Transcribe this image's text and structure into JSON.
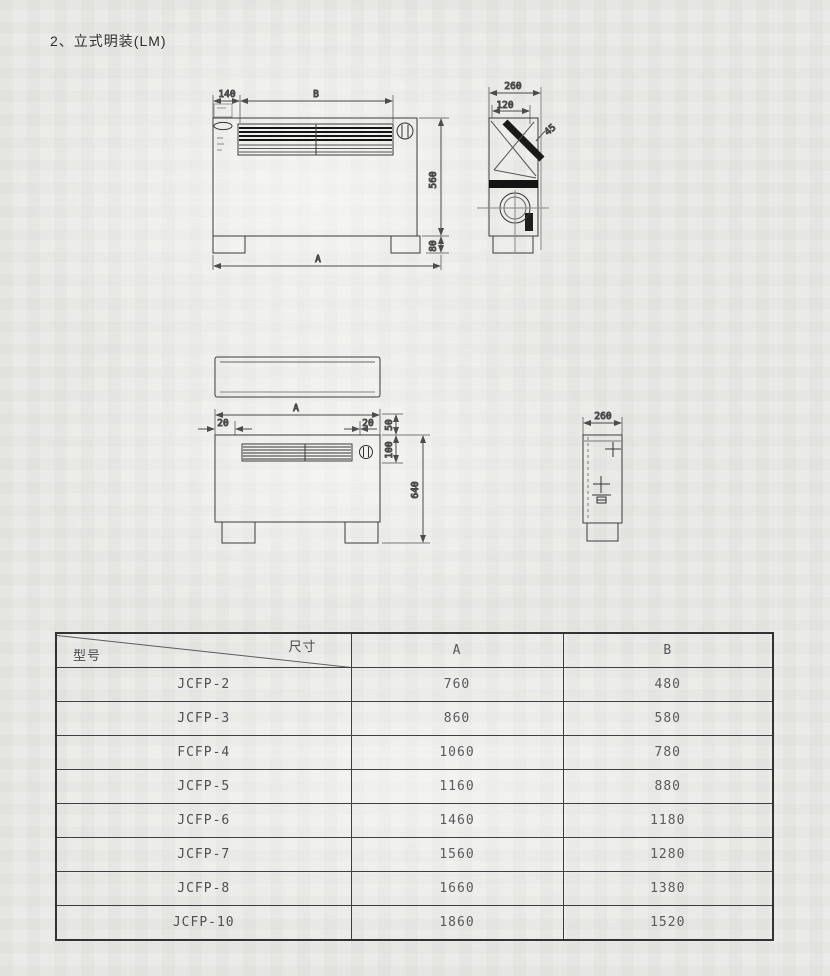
{
  "page": {
    "title": "2、立式明装(LM)"
  },
  "drawings": {
    "front_view": {
      "dim_top_left": "140",
      "dim_top_width": "B",
      "dim_height": "560",
      "dim_foot_height": "80",
      "dim_total_width": "A"
    },
    "side_view_top": {
      "dim_depth": "260",
      "dim_inner": "120",
      "dim_angle": "45"
    },
    "front_view_mounted": {
      "dim_total_width": "A",
      "dim_left_offset": "20",
      "dim_right_offset": "20",
      "dim_top_gap": "50",
      "dim_grille_height": "100",
      "dim_total_height": "640"
    },
    "side_view_mounted": {
      "dim_depth": "260"
    }
  },
  "table": {
    "corner": {
      "top_right": "尺寸",
      "bottom_left": "型号"
    },
    "columns": [
      "A",
      "B"
    ],
    "rows": [
      {
        "model": "JCFP-2",
        "a": "760",
        "b": "480"
      },
      {
        "model": "JCFP-3",
        "a": "860",
        "b": "580"
      },
      {
        "model": "FCFP-4",
        "a": "1060",
        "b": "780"
      },
      {
        "model": "JCFP-5",
        "a": "1160",
        "b": "880"
      },
      {
        "model": "JCFP-6",
        "a": "1460",
        "b": "1180"
      },
      {
        "model": "JCFP-7",
        "a": "1560",
        "b": "1280"
      },
      {
        "model": "JCFP-8",
        "a": "1660",
        "b": "1380"
      },
      {
        "model": "JCFP-10",
        "a": "1860",
        "b": "1520"
      }
    ]
  }
}
